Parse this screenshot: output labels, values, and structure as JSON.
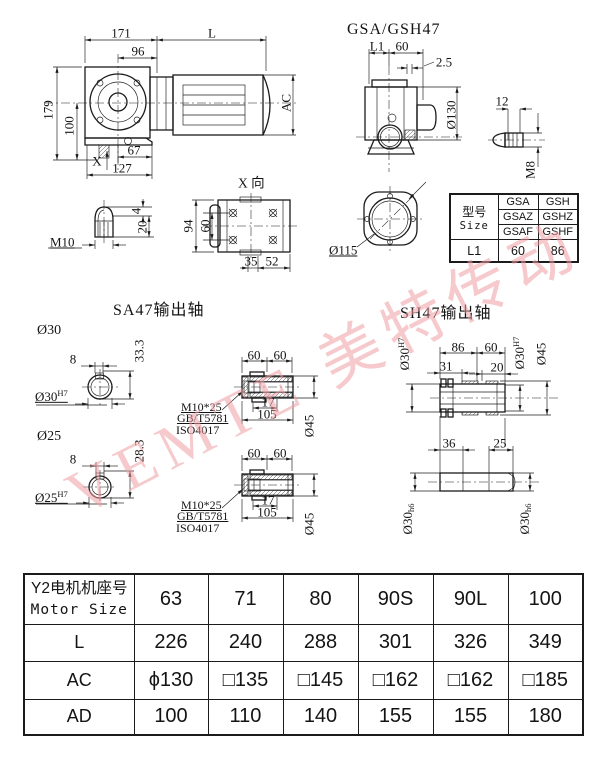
{
  "watermark": {
    "text": "VEMTE 美特传动",
    "color": "#ee9fa4"
  },
  "views": {
    "assembly": {
      "dims": {
        "w171": "171",
        "L": "L",
        "w96": "96",
        "h179": "179",
        "h100": "100",
        "x_mark": "X",
        "w67": "67",
        "w127": "127",
        "ac": "AC"
      }
    },
    "side": {
      "title": "GSA/GSH47",
      "dims": {
        "l1": "L1",
        "d60": "60",
        "gap": "2.5",
        "dia130": "Ø130",
        "d12": "12",
        "m8": "M8"
      }
    },
    "plug": {
      "dims": {
        "d4": "4",
        "d20": "20",
        "m10": "M10"
      }
    },
    "xview": {
      "title": "X 向",
      "dims": {
        "h94": "94",
        "h60": "60",
        "w35": "35",
        "w52": "52"
      }
    },
    "flange": {
      "dims": {
        "dia115": "Ø115"
      }
    },
    "spec_table": {
      "header_cn": "型号",
      "header_en": "Size",
      "models": [
        [
          "GSA",
          "GSH"
        ],
        [
          "GSAZ",
          "GSHZ"
        ],
        [
          "GSAF",
          "GSHF"
        ]
      ],
      "l1_label": "L1",
      "l1_values": [
        "60",
        "86"
      ]
    },
    "sa47": {
      "title": "SA47输出轴",
      "bore30": {
        "label": "Ø30",
        "w8": "8",
        "h": "33.3",
        "fit": "Ø30",
        "fit_tol": "H7"
      },
      "bore25": {
        "label": "Ø25",
        "w8": "8",
        "h": "28.3",
        "fit": "Ø25",
        "fit_tol": "H7"
      },
      "shaft_upper": {
        "d60a": "60",
        "d60b": "60",
        "d17": "17",
        "d105": "105",
        "dia45": "Ø45",
        "bolt": "M10*25",
        "std1": "GB/T5781",
        "std2": "ISO4017"
      },
      "shaft_lower": {
        "d60a": "60",
        "d60b": "60",
        "d17": "17",
        "d105": "105",
        "dia45": "Ø45",
        "bolt": "M10*25",
        "std1": "GB/T5781",
        "std2": "ISO4017"
      }
    },
    "sh47": {
      "title": "SH47输出轴",
      "hollow": {
        "d86": "86",
        "d60": "60",
        "d31": "31",
        "d20": "20",
        "fit_left": "Ø30",
        "fit_left_tol": "H7",
        "fit_right": "Ø30",
        "fit_right_tol": "H7",
        "dia45": "Ø45"
      },
      "solid": {
        "d36": "36",
        "d25": "25",
        "fit_left": "Ø30",
        "fit_left_tol": "h6",
        "fit_right": "Ø30",
        "fit_right_tol": "h6"
      }
    }
  },
  "motor_table": {
    "header": {
      "label_cn": "Y2电机机座号",
      "label_en": "Motor Size",
      "values": [
        "63",
        "71",
        "80",
        "90S",
        "90L",
        "100"
      ]
    },
    "rows": [
      {
        "label": "L",
        "values": [
          "226",
          "240",
          "288",
          "301",
          "326",
          "349"
        ]
      },
      {
        "label": "AC",
        "values": [
          "ϕ130",
          "□135",
          "□145",
          "□162",
          "□162",
          "□185"
        ]
      },
      {
        "label": "AD",
        "values": [
          "100",
          "110",
          "140",
          "155",
          "155",
          "180"
        ]
      }
    ]
  }
}
